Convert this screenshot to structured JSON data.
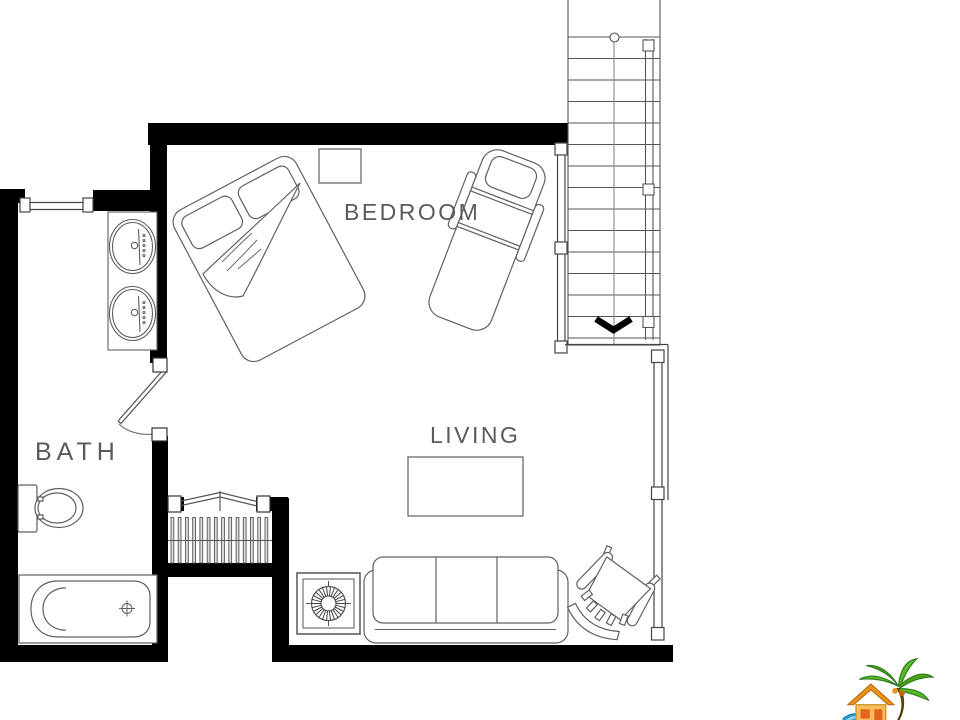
{
  "labels": {
    "bedroom": "BEDROOM",
    "living": "LIVING",
    "bath": "BATH"
  },
  "colors": {
    "wall": "#000000",
    "line": "#5f5f5f",
    "thin_line": "#555555",
    "text": "#5a5a5a",
    "baluster_fill": "#dcdcdc",
    "logo_green": "#5cb82a",
    "logo_dark_green": "#2e7d1e",
    "logo_orange": "#e8941f",
    "logo_dark_orange": "#c06a0c",
    "logo_tan": "#f6bd5a",
    "logo_blue": "#2a9fd8",
    "logo_light_blue": "#9fd8f2",
    "logo_trunk": "#7b4a12"
  },
  "stairs": {
    "upper_tread_count": 15,
    "direction_arrow": "down-chevron"
  },
  "fixtures": [
    "double-bed",
    "nightstand",
    "chaise-lounge",
    "vanity-two-sinks",
    "toilet",
    "bathtub",
    "bathroom-door",
    "window",
    "coffee-table",
    "sofa",
    "stove",
    "armchair",
    "staircase-up",
    "staircase-down",
    "railing"
  ]
}
